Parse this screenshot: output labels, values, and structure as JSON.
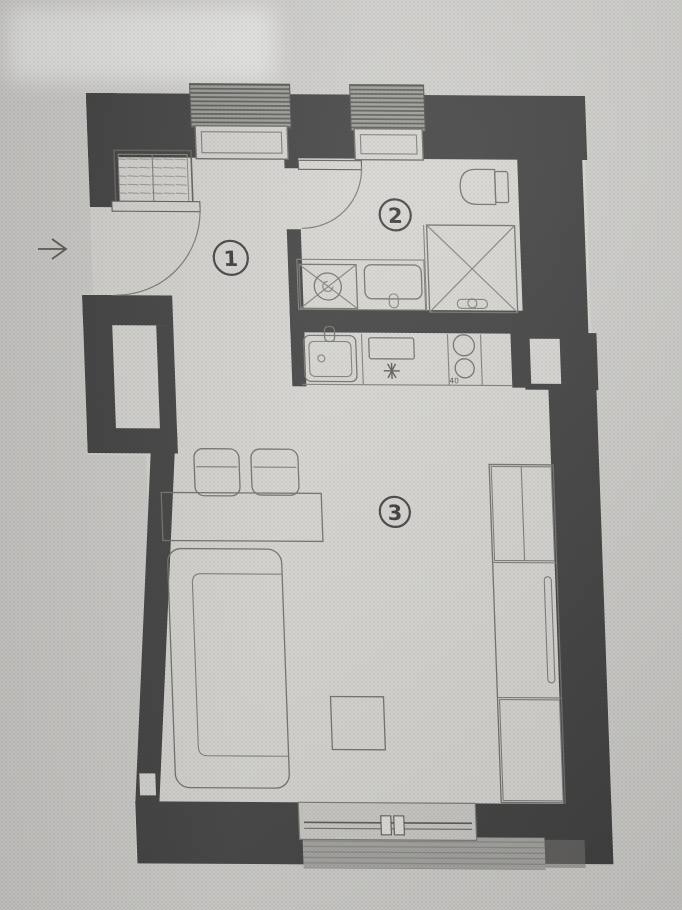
{
  "colors": {
    "paper": "#cfcecb",
    "floor": "#d8d7d3",
    "wall": "#3a3a3a",
    "window_outer": "#9a9a97",
    "window_frame": "#d6d5d1",
    "lintel": "#d2d1cd",
    "slab": "#a4a3a0",
    "balcony_band": "#cbcac6",
    "mullion": "#e2e1dd",
    "label": "#343434"
  },
  "plan": {
    "rooms": [
      {
        "number": "1"
      },
      {
        "number": "2"
      },
      {
        "number": "3"
      }
    ],
    "annotations": {
      "cooktop_dimension": "40"
    }
  },
  "icons": {
    "entrance_arrow": "right-arrow"
  }
}
